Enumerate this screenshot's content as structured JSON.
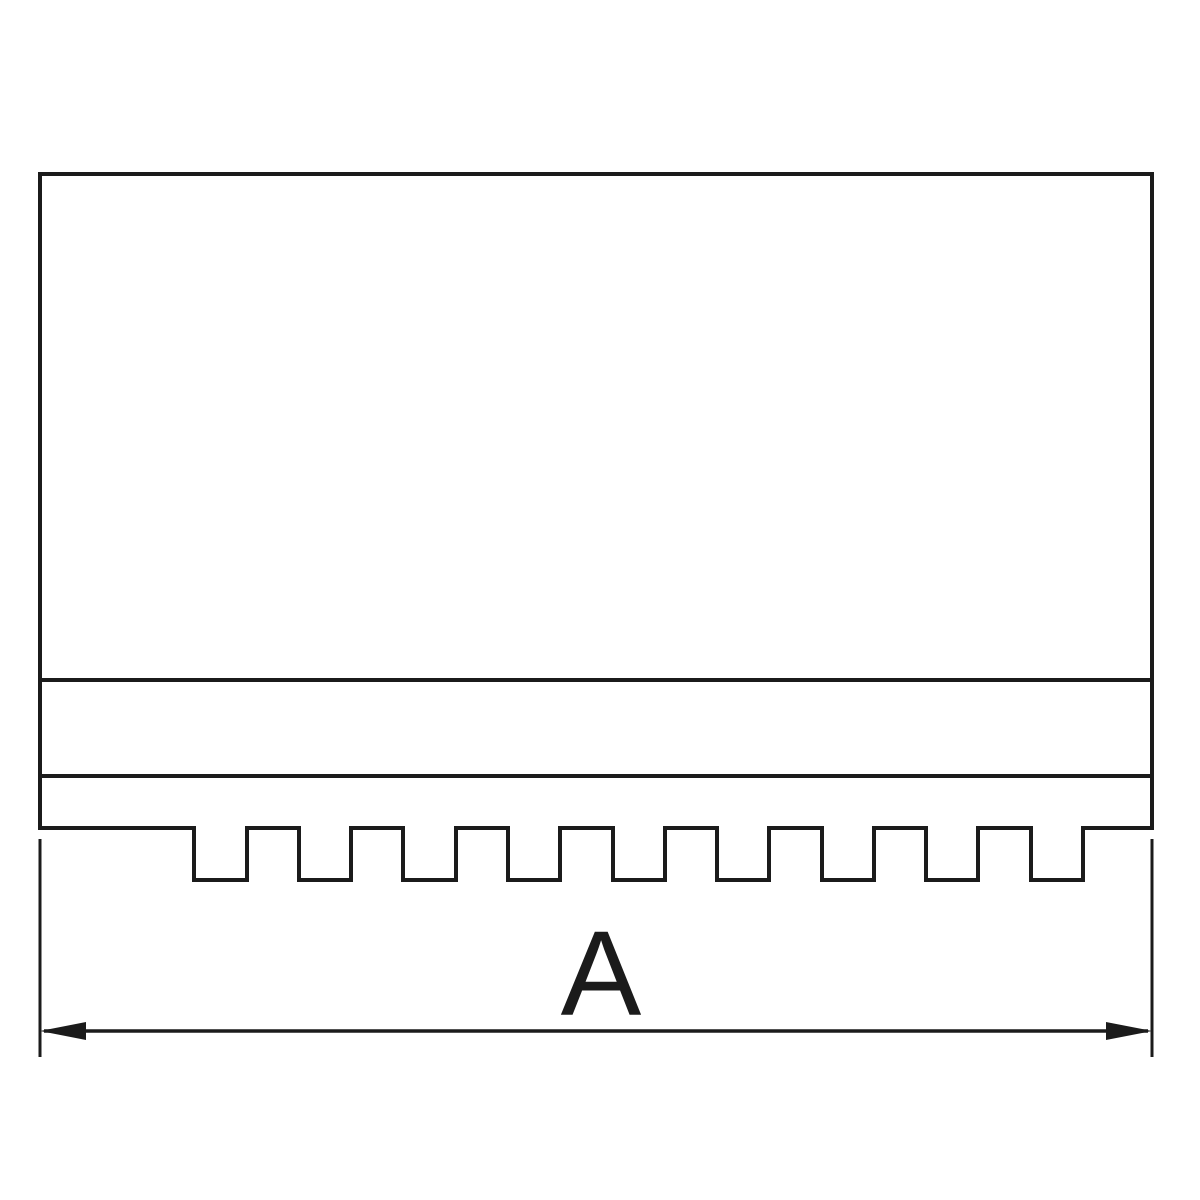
{
  "drawing": {
    "background_color": "#ffffff",
    "line_color": "#1b1b1b",
    "dimension_label": "A"
  }
}
